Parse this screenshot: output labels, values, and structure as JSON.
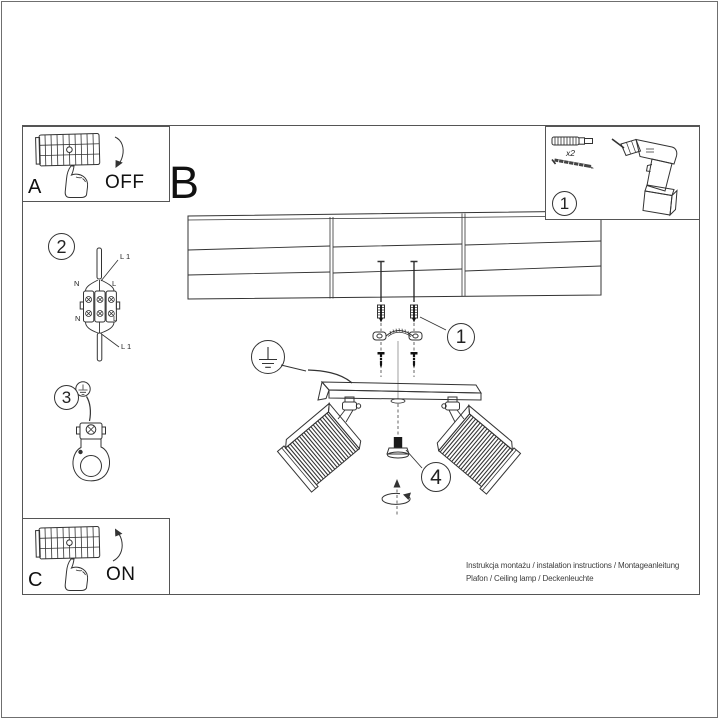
{
  "colors": {
    "ink": "#333333",
    "page_border": "#6f6f6f",
    "frame_border": "#555555",
    "text": "#1a1a1a"
  },
  "panels": {
    "a": {
      "label": "A",
      "action": "OFF"
    },
    "b": {
      "label": "B"
    },
    "c": {
      "label": "C",
      "action": "ON"
    }
  },
  "step_numbers": {
    "parts": "1",
    "bracket": "1",
    "wiring": "2",
    "ground": "3",
    "adjust": "4"
  },
  "parts": {
    "anchor_screw_qty": "x2"
  },
  "wiring_labels": {
    "line_top": "L 1",
    "neutral_top": "N",
    "live_top": "L",
    "neutral_bottom": "N",
    "live_bottom": "L",
    "line_bottom": "L 1"
  },
  "footer": {
    "line1": "Instrukcja montażu / instalation instructions / Montageanleitung",
    "line2": "Plafon / Ceiling lamp / Deckenleuchte"
  }
}
